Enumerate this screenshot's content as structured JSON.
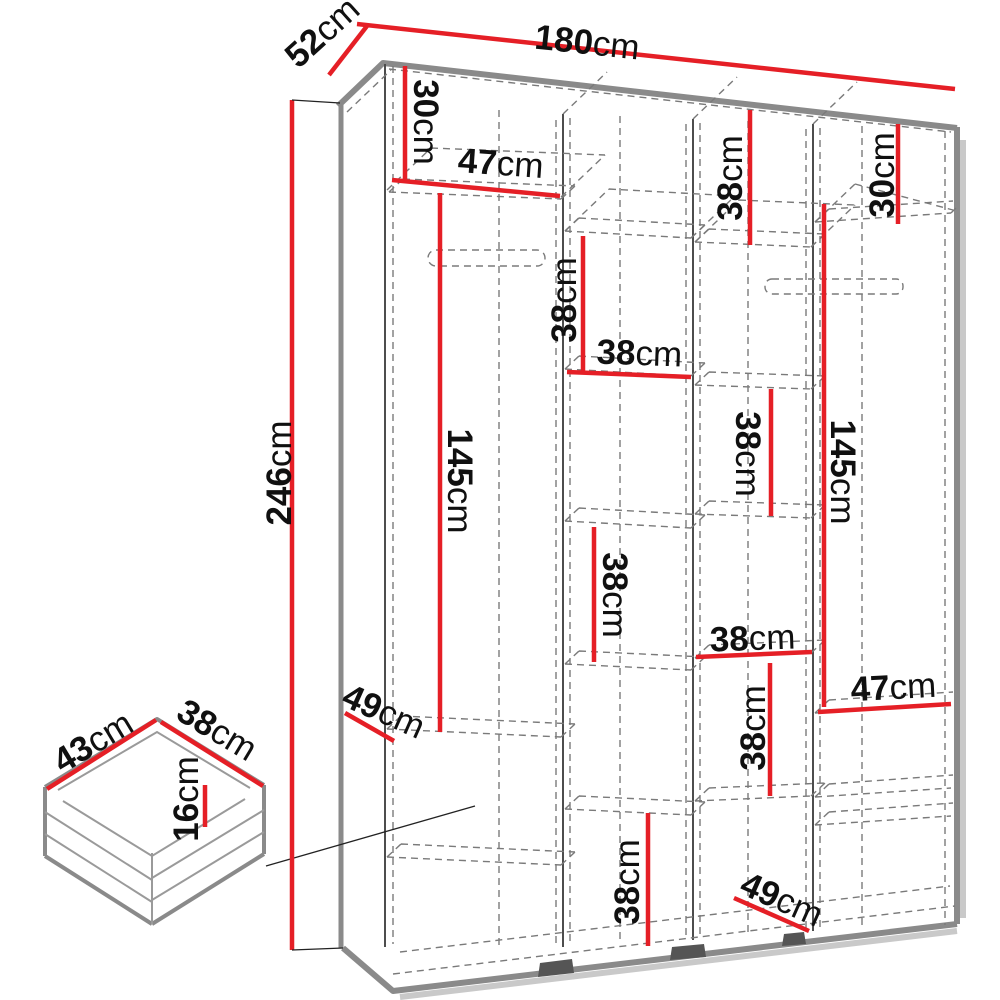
{
  "page": {
    "background": "#ffffff",
    "description": "Technical dimension diagram of a four-section wardrobe with a detail drawing of a drawer"
  },
  "colors": {
    "dimension_line": "#e51f26",
    "outline": "#8a8a8a",
    "hidden_line": "#7a7a7a",
    "label_text": "#101010"
  },
  "unit": "cm",
  "dims": {
    "total_width": {
      "value": "180",
      "unit": "cm"
    },
    "total_depth": {
      "value": "52",
      "unit": "cm"
    },
    "total_height": {
      "value": "246",
      "unit": "cm"
    },
    "top_left_height": {
      "value": "30",
      "unit": "cm"
    },
    "top_left_width": {
      "value": "47",
      "unit": "cm"
    },
    "top_col3_height": {
      "value": "38",
      "unit": "cm"
    },
    "top_right_height": {
      "value": "30",
      "unit": "cm"
    },
    "col2_upper_height": {
      "value": "38",
      "unit": "cm"
    },
    "col2_mid_width": {
      "value": "38",
      "unit": "cm"
    },
    "col3_mid_height": {
      "value": "38",
      "unit": "cm"
    },
    "left_hanging_height": {
      "value": "145",
      "unit": "cm"
    },
    "right_hanging_height": {
      "value": "145",
      "unit": "cm"
    },
    "col2_lower_height": {
      "value": "38",
      "unit": "cm"
    },
    "col3_lower_width": {
      "value": "38",
      "unit": "cm"
    },
    "right_shelf_width": {
      "value": "47",
      "unit": "cm"
    },
    "col3_lower_height": {
      "value": "38",
      "unit": "cm"
    },
    "left_shelf_depth": {
      "value": "49",
      "unit": "cm"
    },
    "col2_bottom_height": {
      "value": "38",
      "unit": "cm"
    },
    "bottom_shelf_depth": {
      "value": "49",
      "unit": "cm"
    },
    "drawer_depth": {
      "value": "43",
      "unit": "cm"
    },
    "drawer_width": {
      "value": "38",
      "unit": "cm"
    },
    "drawer_height": {
      "value": "16",
      "unit": "cm"
    }
  }
}
